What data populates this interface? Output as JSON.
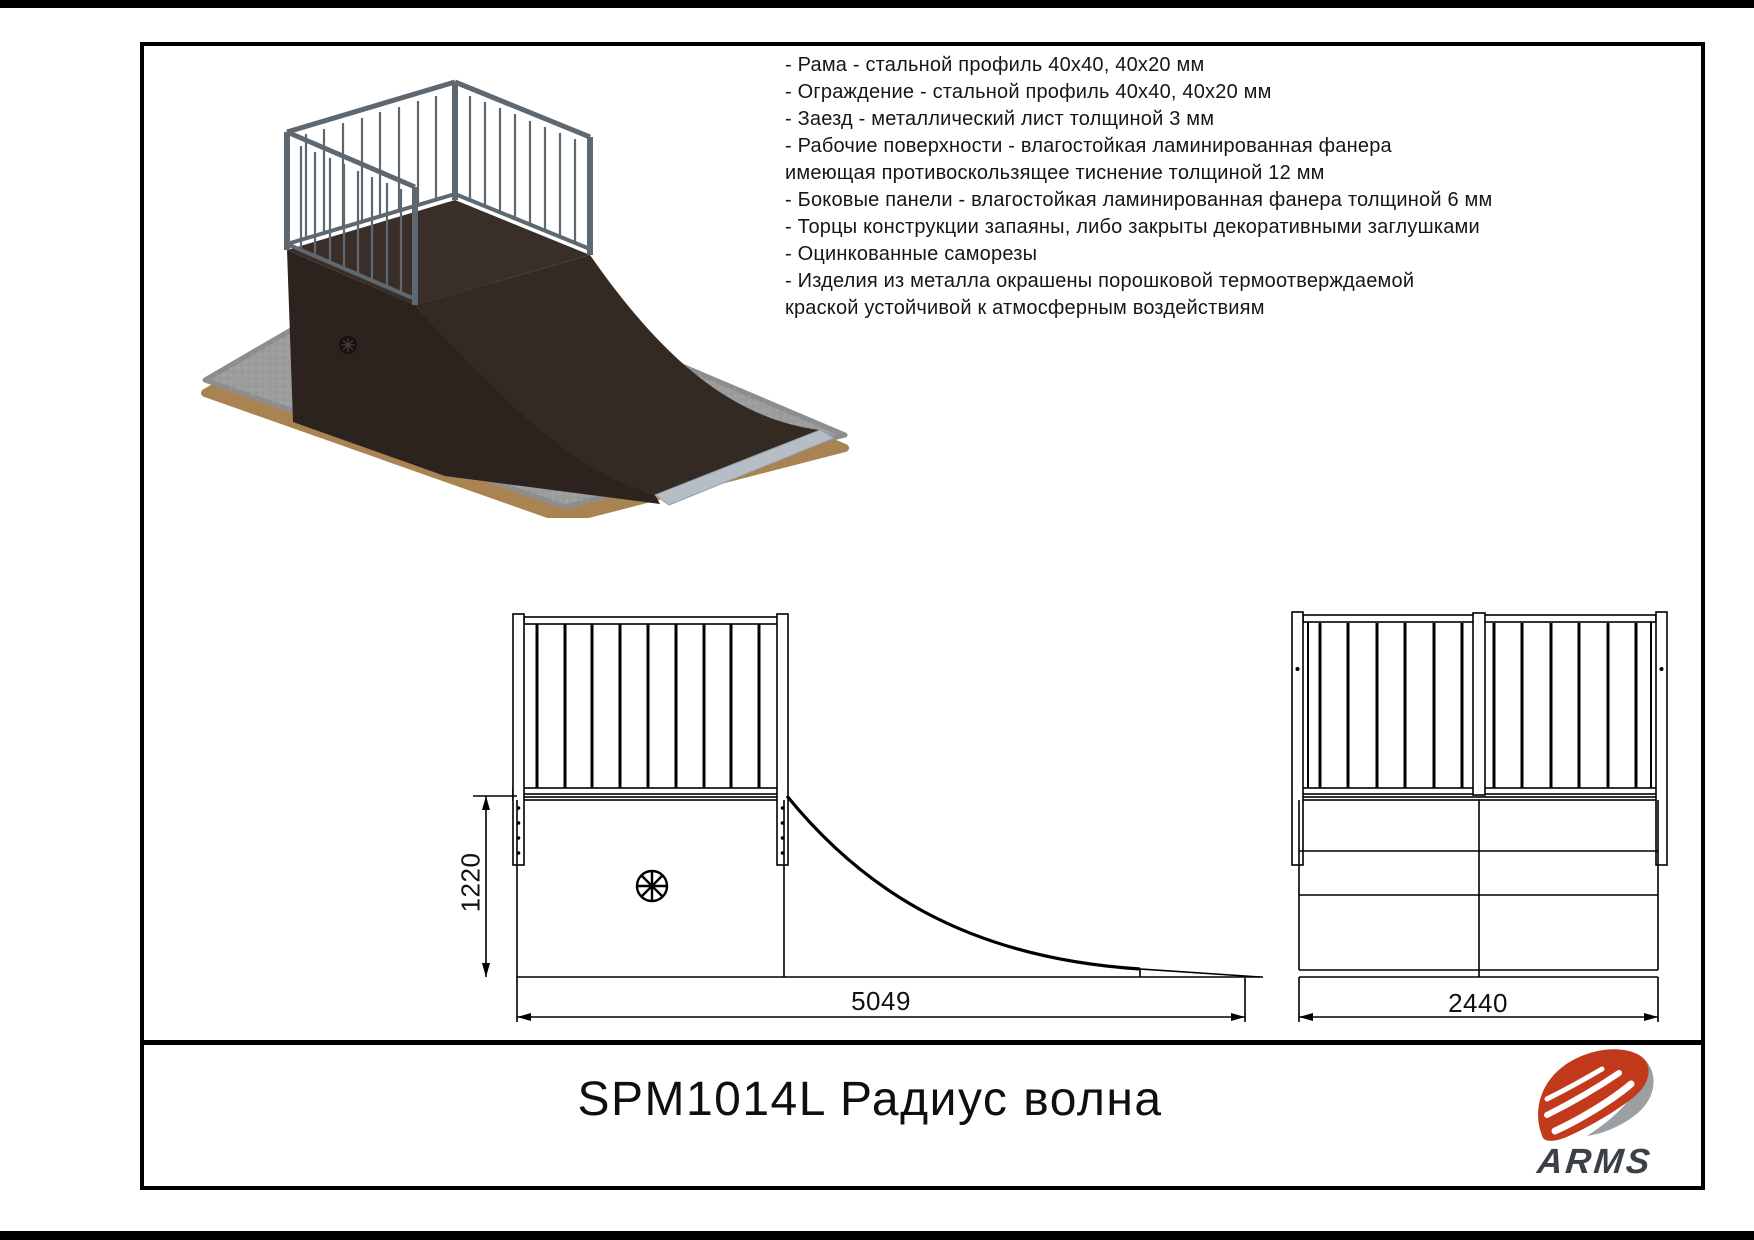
{
  "page": {
    "title": "SPM1014L Радиус волна"
  },
  "specs": {
    "lines": [
      "- Рама - стальной профиль 40х40, 40х20 мм",
      "- Ограждение - стальной профиль 40х40, 40х20 мм",
      "- Заезд - металлический лист толщиной 3 мм",
      "- Рабочие поверхности - влагостойкая ламинированная фанера",
      "имеющая противоскользящее тиснение толщиной 12 мм",
      "- Боковые панели - влагостойкая ламинированная фанера толщиной 6 мм",
      "- Торцы конструкции запаяны, либо закрыты декоративными заглушками",
      "- Оцинкованные саморезы",
      "- Изделия из металла окрашены порошковой термоотверждаемой",
      "краской устойчивой к атмосферным воздействиям"
    ]
  },
  "views": {
    "side": {
      "height_label": "1220",
      "length_label": "5049"
    },
    "front": {
      "width_label": "2440"
    }
  },
  "logo": {
    "brand": "ARMS"
  },
  "colors": {
    "accent_red": "#c23a1b",
    "logo_grey": "#9aa0a4",
    "logo_text": "#3a4045",
    "steel_grey": "#5d6871",
    "body_dark": "#2c231e",
    "body_top": "#3a2f28",
    "ramp_face": "#342a24",
    "plate_grey": "#b5bec6",
    "pad_grey": "#9d9d9d",
    "pad_rim": "#aa8353",
    "drawing_line": "#000000"
  }
}
